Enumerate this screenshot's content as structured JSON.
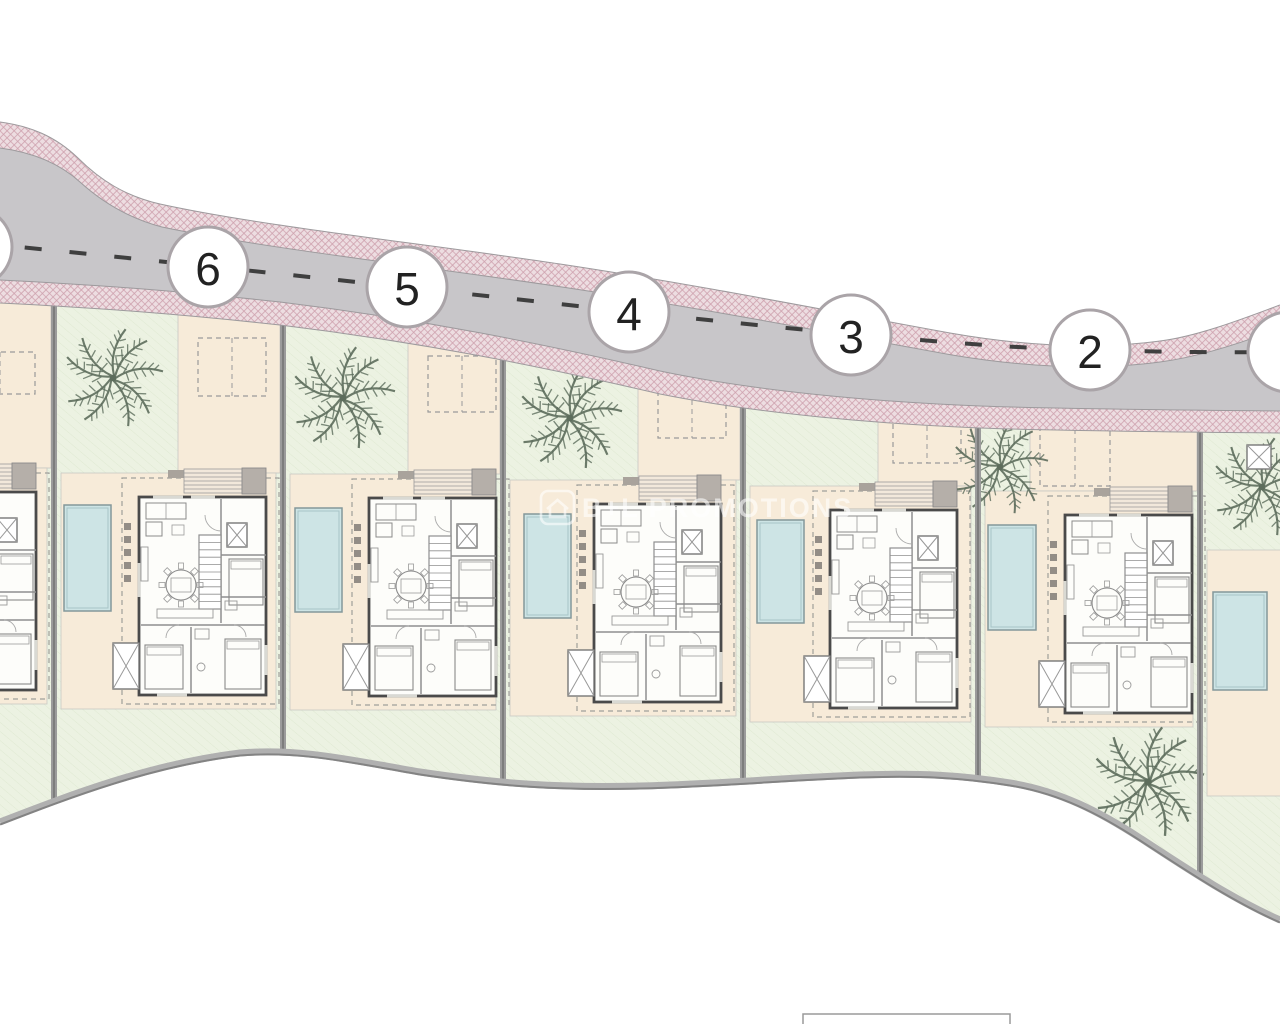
{
  "page": {
    "title": "Villa development site plan",
    "background": "#ffffff"
  },
  "watermark": {
    "text": "B+L PROMOTIONS",
    "logo": "house-icon",
    "color": "rgba(255,255,255,0.65)"
  },
  "road": {
    "surface_color": "#c8c6c9",
    "sidewalk_color": "#eddde1",
    "hatch_color": "#c795a3",
    "centerline_color": "#3f3f3f",
    "badge_border_color": "#aaa4a8",
    "badges": [
      {
        "label": "6",
        "x": 208,
        "y": 267
      },
      {
        "label": "5",
        "x": 407,
        "y": 287
      },
      {
        "label": "4",
        "x": 629,
        "y": 312
      },
      {
        "label": "3",
        "x": 851,
        "y": 335
      },
      {
        "label": "2",
        "x": 1090,
        "y": 350
      },
      {
        "label": "",
        "x": -28,
        "y": 247
      },
      {
        "label": "",
        "x": 1288,
        "y": 352
      }
    ]
  },
  "colors": {
    "garden": "#ecf2e2",
    "garden_line": "#dfe9d2",
    "patio": "#f7ebd9",
    "patio_border": "#cdbfa9",
    "pool_fill": "#cde4e5",
    "pool_border": "#83989a",
    "wall": "#4a4a4a",
    "interior_line": "#8f8f8f",
    "divider": "#9b9b9b",
    "boundary": "#b0b0b0",
    "boundary_edge": "#838383",
    "palm": "#5d6d5c",
    "canopy_gray": "#b5afa9",
    "entrance_gray": "#a9a39c"
  },
  "plots": [
    {
      "name": "plot-7-partial",
      "x_left": -176,
      "x_right": 54,
      "split_x": -30,
      "patio_top": 468,
      "villa": {
        "x": -91,
        "y": 492
      },
      "pool": null,
      "parking": {
        "x": -35,
        "y": 352,
        "w": 70,
        "h": 42
      },
      "palms": []
    },
    {
      "name": "plot-6",
      "x_left": 54,
      "x_right": 283,
      "split_x": 178,
      "patio_top": 473,
      "villa": {
        "x": 139,
        "y": 497
      },
      "pool": {
        "x": 64,
        "y": 505,
        "w": 47,
        "h": 106
      },
      "parking": {
        "x": 198,
        "y": 338,
        "w": 68,
        "h": 58
      },
      "palms": [
        {
          "x": 113,
          "y": 378,
          "r": 50
        }
      ]
    },
    {
      "name": "plot-5",
      "x_left": 283,
      "x_right": 503,
      "split_x": 408,
      "patio_top": 474,
      "villa": {
        "x": 369,
        "y": 498
      },
      "pool": {
        "x": 295,
        "y": 508,
        "w": 47,
        "h": 104
      },
      "parking": {
        "x": 428,
        "y": 356,
        "w": 68,
        "h": 56
      },
      "palms": [
        {
          "x": 343,
          "y": 398,
          "r": 52
        }
      ]
    },
    {
      "name": "plot-4",
      "x_left": 503,
      "x_right": 743,
      "split_x": 638,
      "patio_top": 480,
      "villa": {
        "x": 594,
        "y": 504
      },
      "pool": {
        "x": 524,
        "y": 514,
        "w": 47,
        "h": 104
      },
      "parking": {
        "x": 658,
        "y": 382,
        "w": 68,
        "h": 56
      },
      "palms": [
        {
          "x": 570,
          "y": 418,
          "r": 52
        }
      ]
    },
    {
      "name": "plot-3",
      "x_left": 743,
      "x_right": 978,
      "split_x": 878,
      "patio_top": 486,
      "villa": {
        "x": 830,
        "y": 510
      },
      "pool": {
        "x": 757,
        "y": 520,
        "w": 47,
        "h": 103
      },
      "parking": {
        "x": 893,
        "y": 408,
        "w": 68,
        "h": 55
      },
      "palms": []
    },
    {
      "name": "plot-2",
      "x_left": 978,
      "x_right": 1200,
      "split_x": 1030,
      "patio_top": 491,
      "villa": {
        "x": 1065,
        "y": 515
      },
      "pool": {
        "x": 988,
        "y": 525,
        "w": 48,
        "h": 105
      },
      "parking": {
        "x": 1040,
        "y": 429,
        "w": 70,
        "h": 57
      },
      "palms": [
        {
          "x": 1000,
          "y": 467,
          "r": 48
        },
        {
          "x": 1148,
          "y": 782,
          "r": 56
        }
      ]
    },
    {
      "name": "plot-1-partial",
      "x_left": 1200,
      "x_right": 1292,
      "split_x": null,
      "patio_top": 550,
      "villa": null,
      "pool": {
        "x": 1213,
        "y": 592,
        "w": 54,
        "h": 98
      },
      "parking": null,
      "palms": [
        {
          "x": 1262,
          "y": 487,
          "r": 50
        }
      ],
      "extra_lightwell": {
        "x": 1247,
        "y": 445,
        "w": 24,
        "h": 24
      }
    }
  ],
  "legend_stub": {
    "x": 803,
    "y": 1014,
    "w": 207,
    "h": 16
  }
}
